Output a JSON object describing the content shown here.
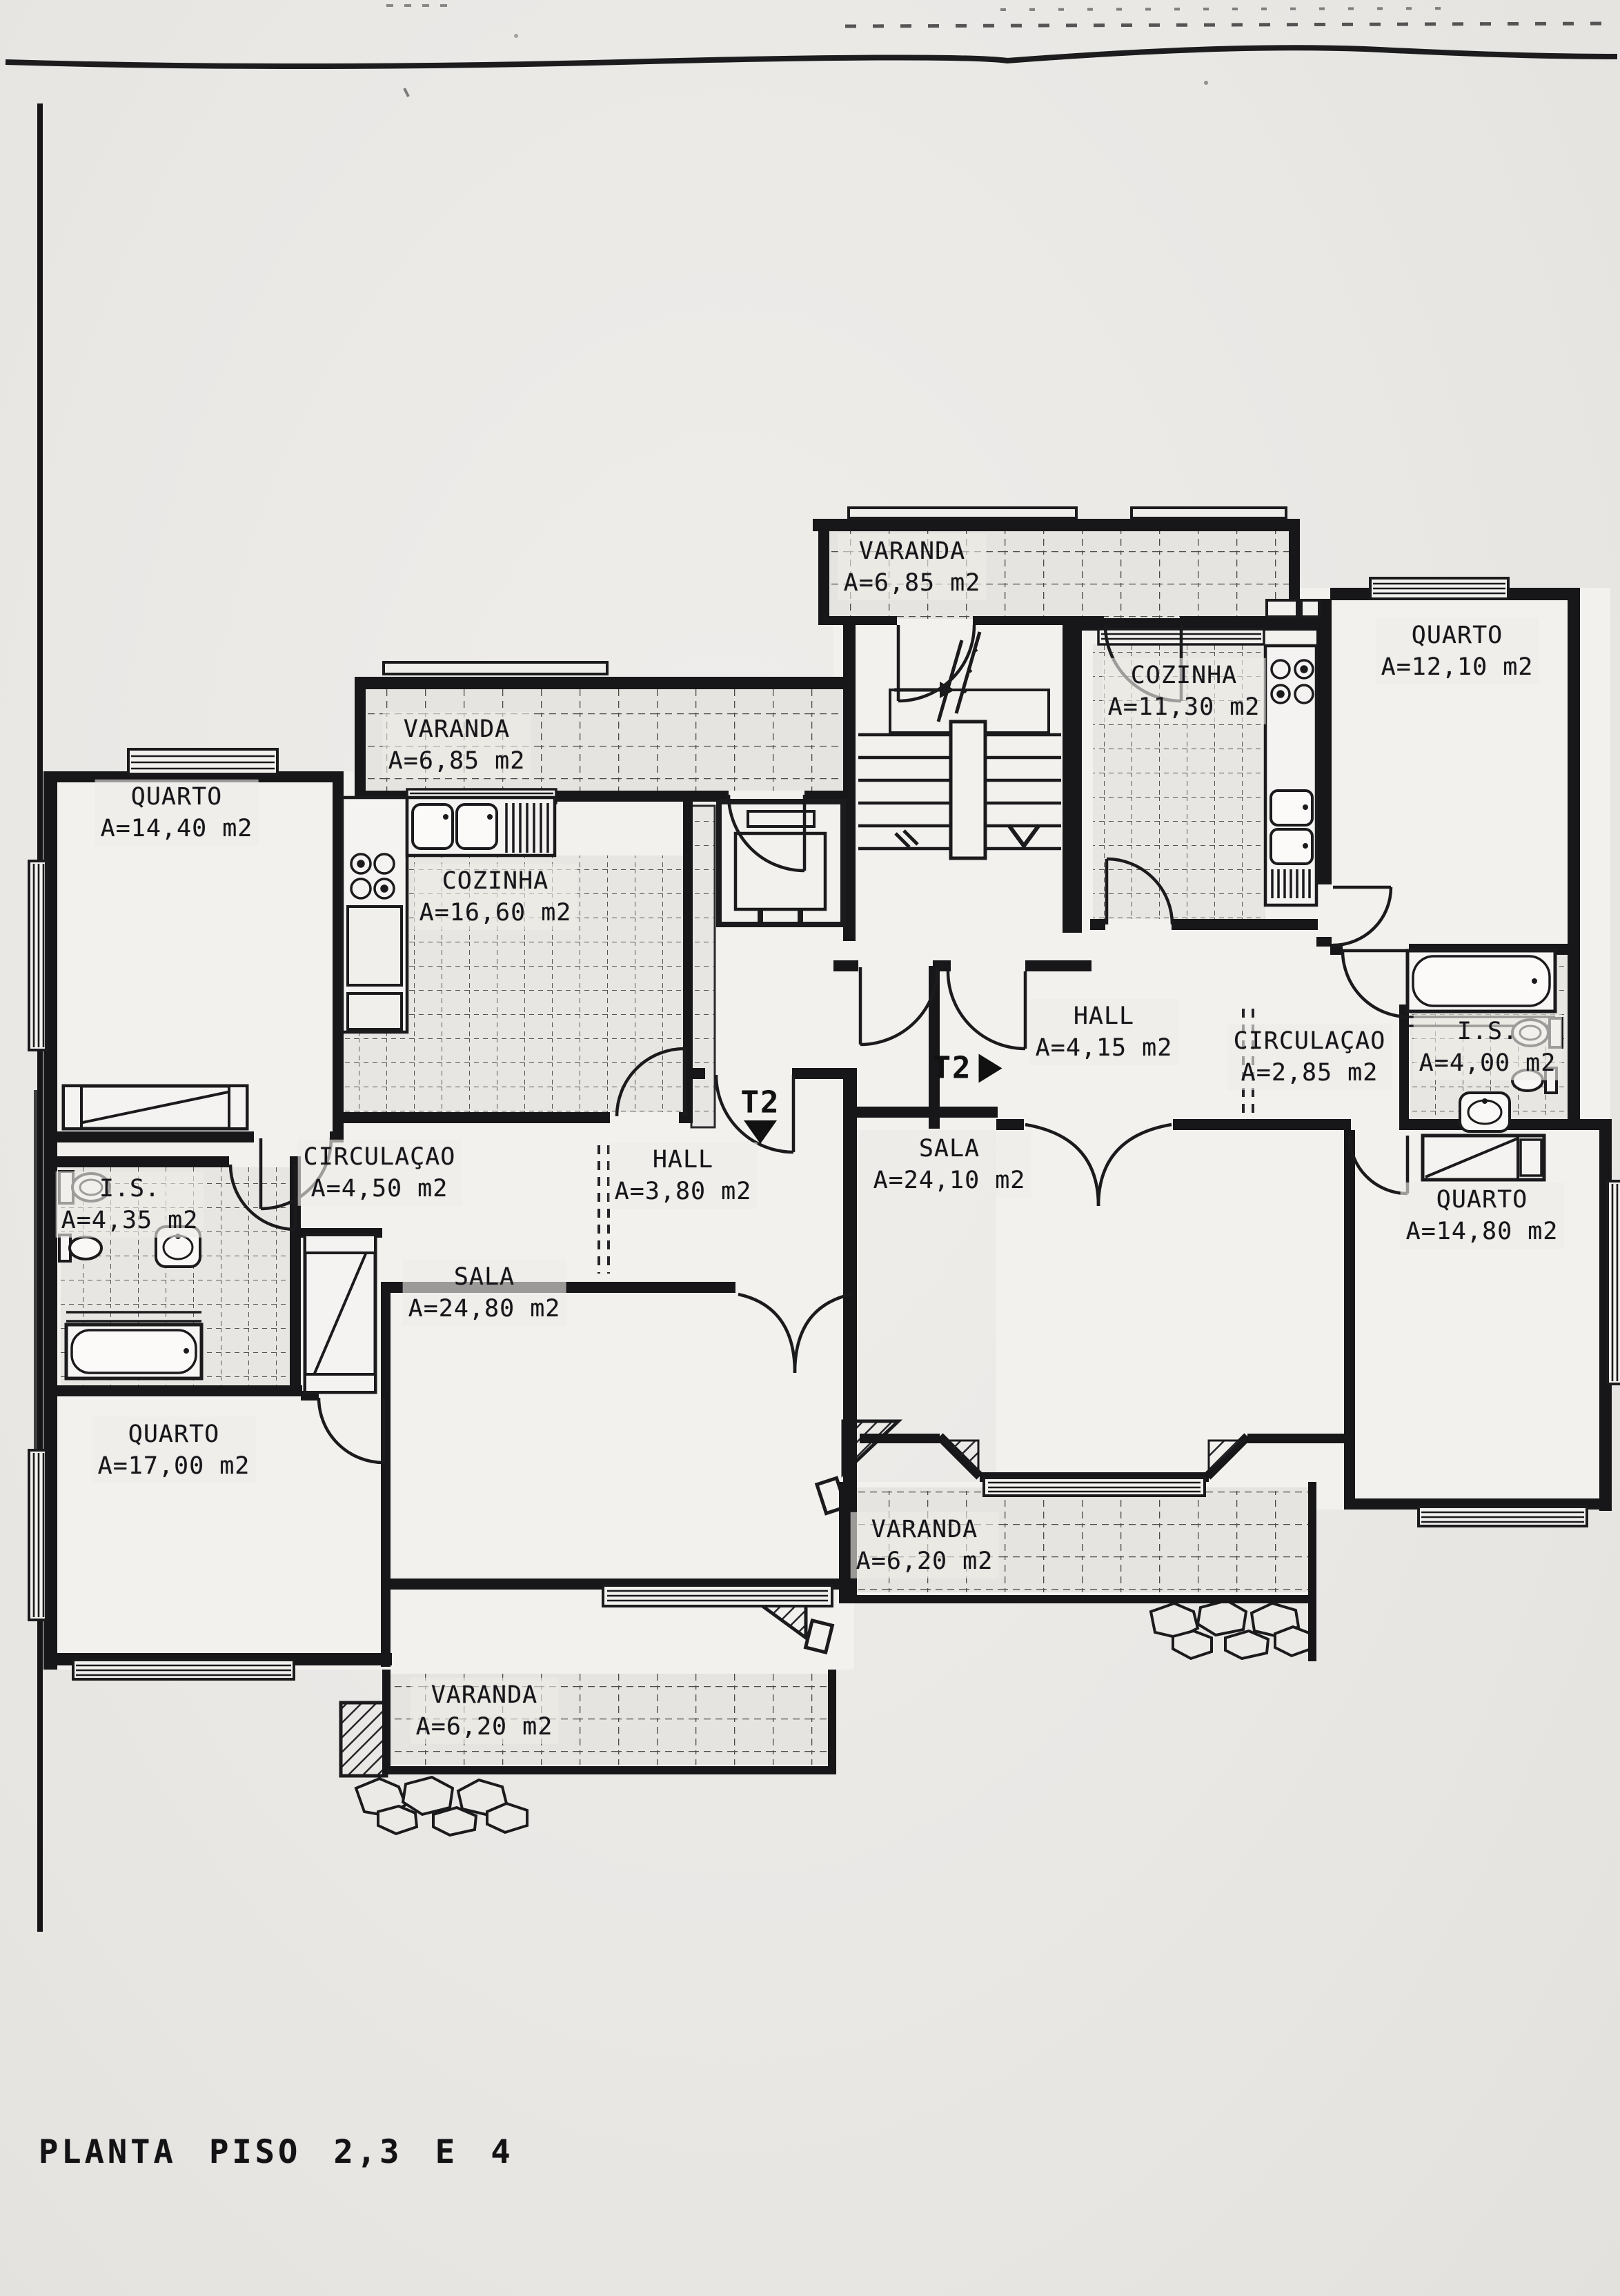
{
  "document": {
    "title": "PLANTA PISO 2,3 E 4"
  },
  "plan": {
    "apartments": [
      {
        "id": "left",
        "type_label": "T2",
        "entry_arrow": "down"
      },
      {
        "id": "right",
        "type_label": "T2",
        "entry_arrow": "right"
      }
    ],
    "entries": {
      "right": {
        "label": "T2"
      },
      "left": {
        "label": "T2"
      }
    },
    "rooms": {
      "varanda_top_right": {
        "name": "VARANDA",
        "area": "A=6,85 m2"
      },
      "cozinha_right": {
        "name": "COZINHA",
        "area": "A=11,30 m2"
      },
      "quarto_top_right": {
        "name": "QUARTO",
        "area": "A=12,10 m2"
      },
      "hall_right": {
        "name": "HALL",
        "area": "A=4,15 m2"
      },
      "circulacao_right": {
        "name": "CIRCULAÇAO",
        "area": "A=2,85 m2"
      },
      "is_right": {
        "name": "I.S.",
        "area": "A=4,00 m2"
      },
      "sala_right": {
        "name": "SALA",
        "area": "A=24,10 m2"
      },
      "quarto_bottom_right": {
        "name": "QUARTO",
        "area": "A=14,80 m2"
      },
      "varanda_bottom_middle": {
        "name": "VARANDA",
        "area": "A=6,20 m2"
      },
      "varanda_left": {
        "name": "VARANDA",
        "area": "A=6,85 m2"
      },
      "quarto_top_left": {
        "name": "QUARTO",
        "area": "A=14,40 m2"
      },
      "cozinha_left": {
        "name": "COZINHA",
        "area": "A=16,60 m2"
      },
      "circulacao_left": {
        "name": "CIRCULAÇAO",
        "area": "A=4,50 m2"
      },
      "hall_left": {
        "name": "HALL",
        "area": "A=3,80 m2"
      },
      "is_left": {
        "name": "I.S.",
        "area": "A=4,35 m2"
      },
      "sala_left": {
        "name": "SALA",
        "area": "A=24,80 m2"
      },
      "quarto_bottom_left": {
        "name": "QUARTO",
        "area": "A=17,00 m2"
      },
      "varanda_bottom_left": {
        "name": "VARANDA",
        "area": "A=6,20 m2"
      }
    },
    "colors": {
      "ink": "#1b1b1d",
      "paper": "#eae8e5",
      "tile_base": "#e6e4e0"
    }
  }
}
